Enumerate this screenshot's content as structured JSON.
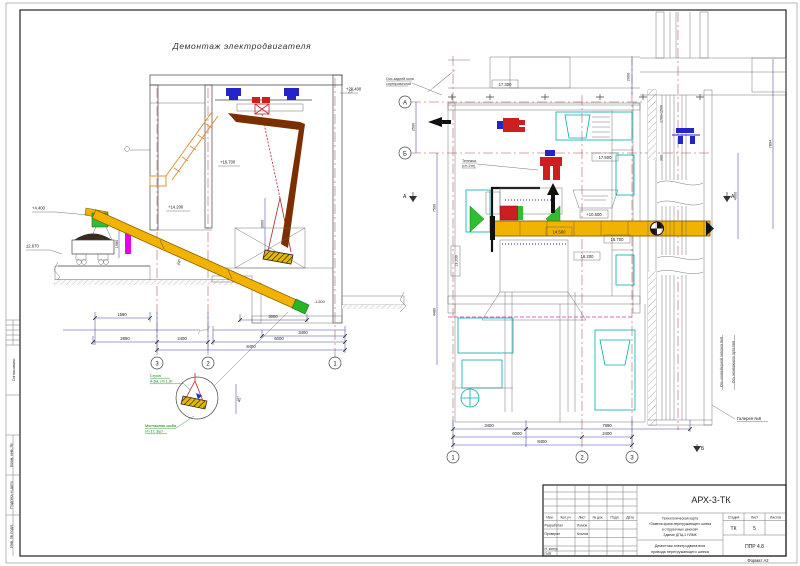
{
  "sheet": {
    "format_label": "Формат А2"
  },
  "stamp_left": {
    "soglasovano": "Согласовано",
    "vzam": "Взам. инв. №",
    "podpis": "Подпись и дата",
    "inv": "Инв. № подл."
  },
  "section_view": {
    "title": "Демонтаж электродвигателя",
    "elevations": {
      "monorail": "+20.400",
      "platform": "+16.700",
      "mid": "+14.200",
      "left_upper": "+4.400",
      "left_lower": "±2.670",
      "pit": "-1.500"
    },
    "dims": {
      "d1580": "1580",
      "d2890": "2890",
      "d2400": "2400",
      "d3000": "3000",
      "d3400": "3400",
      "d6000": "6000",
      "d8400": "8400",
      "v1980": "1980",
      "v3000": "3000"
    },
    "angles": {
      "boom": "24°",
      "sling": "45°"
    },
    "grid": {
      "g3": "3",
      "g2": "2",
      "g1": "1"
    },
    "detail": {
      "strop_1": "Строп",
      "strop_2": "4-3м, г/п 1,0т",
      "skoba_1": "Монтажная скоба",
      "skoba_2": "г/п 1т, 3шт"
    }
  },
  "plan_view": {
    "notes": {
      "axis_note_1": "Ось задней коли",
      "axis_note_2": "сортировочной",
      "hoist_1": "Тележка",
      "hoist_2": "(г/п 2тн)",
      "gallery": "Галерея №6",
      "axis_conv": "Ось конвейерной галереи №6",
      "axis_mono": "Ось монтажного пути №6"
    },
    "elevations": {
      "e17300": "17.300",
      "e17500": "17.500",
      "e10500": "+10.500",
      "e14500": "14.500",
      "e16700": "16.700",
      "e16200": "16.200",
      "e13200": "13.200"
    },
    "dims": {
      "d2500": "2500",
      "d7500": "7500",
      "d4480": "4480",
      "d2000": "2000",
      "d1700": "1700×1500",
      "d300": "300",
      "d4000": "4000",
      "d7894": "7894",
      "d3400": "3400",
      "d6000": "6000",
      "d8400": "8400",
      "d7890": "7890",
      "d2400": "2400"
    },
    "grid": {
      "gA": "А",
      "gB": "Б",
      "g1": "1",
      "g2": "2",
      "g3": "3",
      "secA": "А",
      "secB": "Б"
    }
  },
  "titleblock": {
    "doc_number": "АРХ-3-ТК",
    "header_cells": [
      "Изм.",
      "Кол.уч.",
      "Лист",
      "№ док.",
      "Подп.",
      "Дата"
    ],
    "razrab_label": "Разработал",
    "razrab_name": "Ломов",
    "prover_label": "Проверил",
    "prover_name": "Козлов",
    "ncontr_label": "Н. контр.",
    "gip_label": "ГИП",
    "project_lines": [
      "Технологическая карта",
      "«Замена крана перегружающего шнека",
      "и отгрузочных шнеков»",
      "Здание ДПЦ-1 НЛМК"
    ],
    "title_lines": [
      "Демонтаж электродвигателя",
      "привода перегружающего шнека"
    ],
    "stage_label": "Стадия",
    "sheet_label": "Лист",
    "sheets_label": "Листов",
    "stage_value": "ТК",
    "sheet_value": "5",
    "doc_code": "ППР 4.8"
  }
}
